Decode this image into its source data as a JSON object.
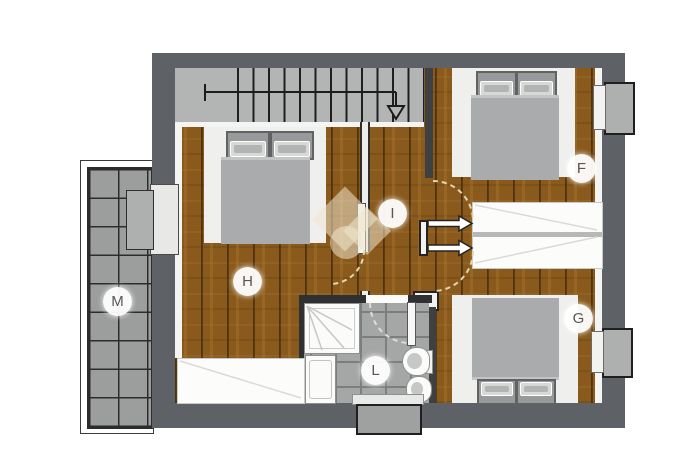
{
  "floorplan": {
    "rooms": {
      "M": {
        "label": "M"
      },
      "H": {
        "label": "H"
      },
      "I": {
        "label": "I"
      },
      "L": {
        "label": "L"
      },
      "F": {
        "label": "F"
      },
      "G": {
        "label": "G"
      }
    },
    "colors": {
      "wall": "#5e6165",
      "wood_floor": "#8a5a1d",
      "stairs": "#b3b5b4",
      "balcony_tile": "#9c9e9d",
      "bath_tile": "#a5a7a6",
      "furniture_white": "#efefed",
      "bed_blanket": "#a9abac",
      "door_swing_dash": "#e3d7b2",
      "watermark": "#efe6cc"
    },
    "fixtures": [
      "staircase",
      "double-bed",
      "wardrobe",
      "shower",
      "washing-machine",
      "toilet",
      "bidet",
      "window",
      "balcony-door",
      "door-swing"
    ]
  }
}
